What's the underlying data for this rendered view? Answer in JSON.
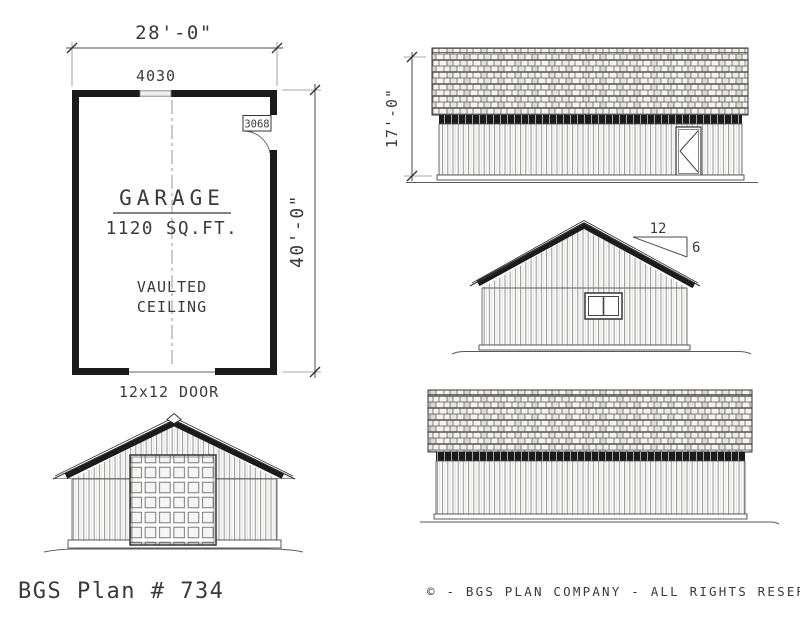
{
  "floor_plan": {
    "width_dim": "28'-0\"",
    "length_dim": "40'-0\"",
    "window_size": "4030",
    "entry_door_size": "3068",
    "room_label": "GARAGE",
    "area_label": "1120 SQ.FT.",
    "ceiling_label_line1": "VAULTED",
    "ceiling_label_line2": "CEILING",
    "overhead_door_label": "12x12 DOOR"
  },
  "left_elevation": {
    "height_dim": "17'-0\""
  },
  "rear_elevation": {
    "pitch": {
      "run": "12",
      "rise": "6"
    }
  },
  "footer": {
    "plan_title": "BGS Plan # 734",
    "copyright": "© - BGS PLAN COMPANY - ALL RIGHTS RESERVED"
  },
  "colors": {
    "line": "#333333",
    "wall": "#1a1a1a",
    "fascia": "#1b1b1b",
    "background": "#ffffff"
  }
}
